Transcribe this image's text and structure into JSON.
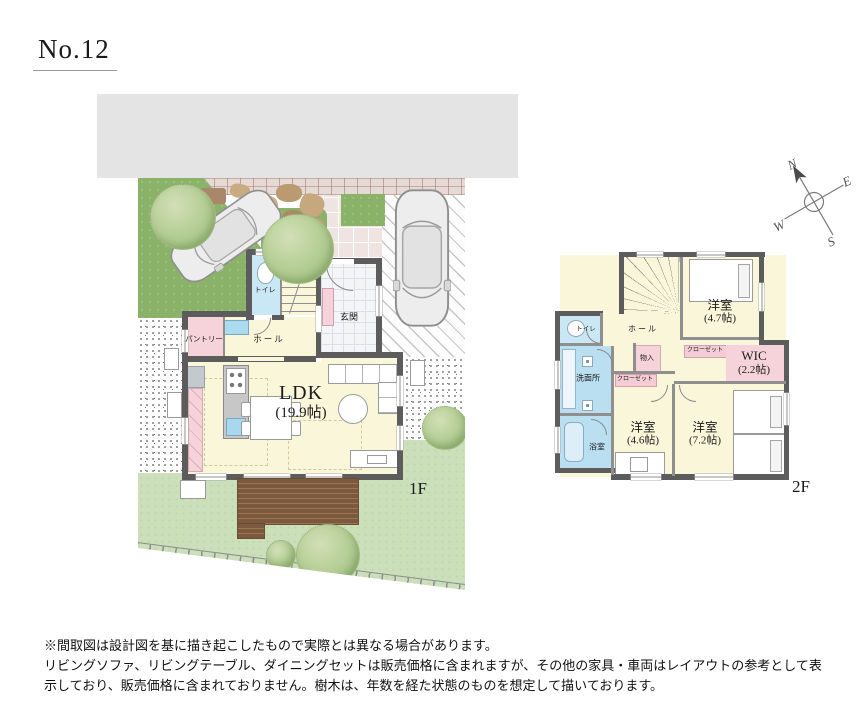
{
  "title": "No.12",
  "compass": {
    "n": "N",
    "e": "E",
    "s": "S",
    "w": "W"
  },
  "floor1": {
    "label": "1F",
    "rooms": {
      "ldk": {
        "name": "LDK",
        "size": "(19.9帖)"
      },
      "genkan": "玄関",
      "hall": "ホール",
      "toilet": "トイレ",
      "pantry": "パントリー"
    }
  },
  "floor2": {
    "label": "2F",
    "rooms": {
      "bedroom_a": {
        "name": "洋室",
        "size": "(4.7帖)"
      },
      "wic": {
        "name": "WIC",
        "size": "(2.2帖)"
      },
      "bedroom_b": {
        "name": "洋室",
        "size": "(4.6帖)"
      },
      "bedroom_c": {
        "name": "洋室",
        "size": "(7.2帖)"
      },
      "closet_a": "クローゼット",
      "closet_b": "クローゼット",
      "storage": "物入",
      "hall": "ホール",
      "toilet": "トイレ",
      "washroom": "洗面所",
      "bath": "浴室"
    }
  },
  "disclaimer": {
    "line1": "※間取図は設計図を基に描き起こしたもので実際とは異なる場合があります。",
    "line2": "リビングソファ、リビングテーブル、ダイニングセットは販売価格に含まれますが、その他の家具・車両はレイアウトの参考として表",
    "line3": "示しており、販売価格に含まれておりません。樹木は、年数を経た状態のものを想定して描いております。"
  },
  "colors": {
    "wall": "#5c5c5c",
    "room_floor": "#faf6da",
    "water_blue": "#b9dff1",
    "closet_pink": "#f6d3db",
    "grass_dark": "#8ab268",
    "lawn": "#cbdfba",
    "deck_brown": "#7c583e",
    "neighbor_gray": "#e4e4e4"
  }
}
